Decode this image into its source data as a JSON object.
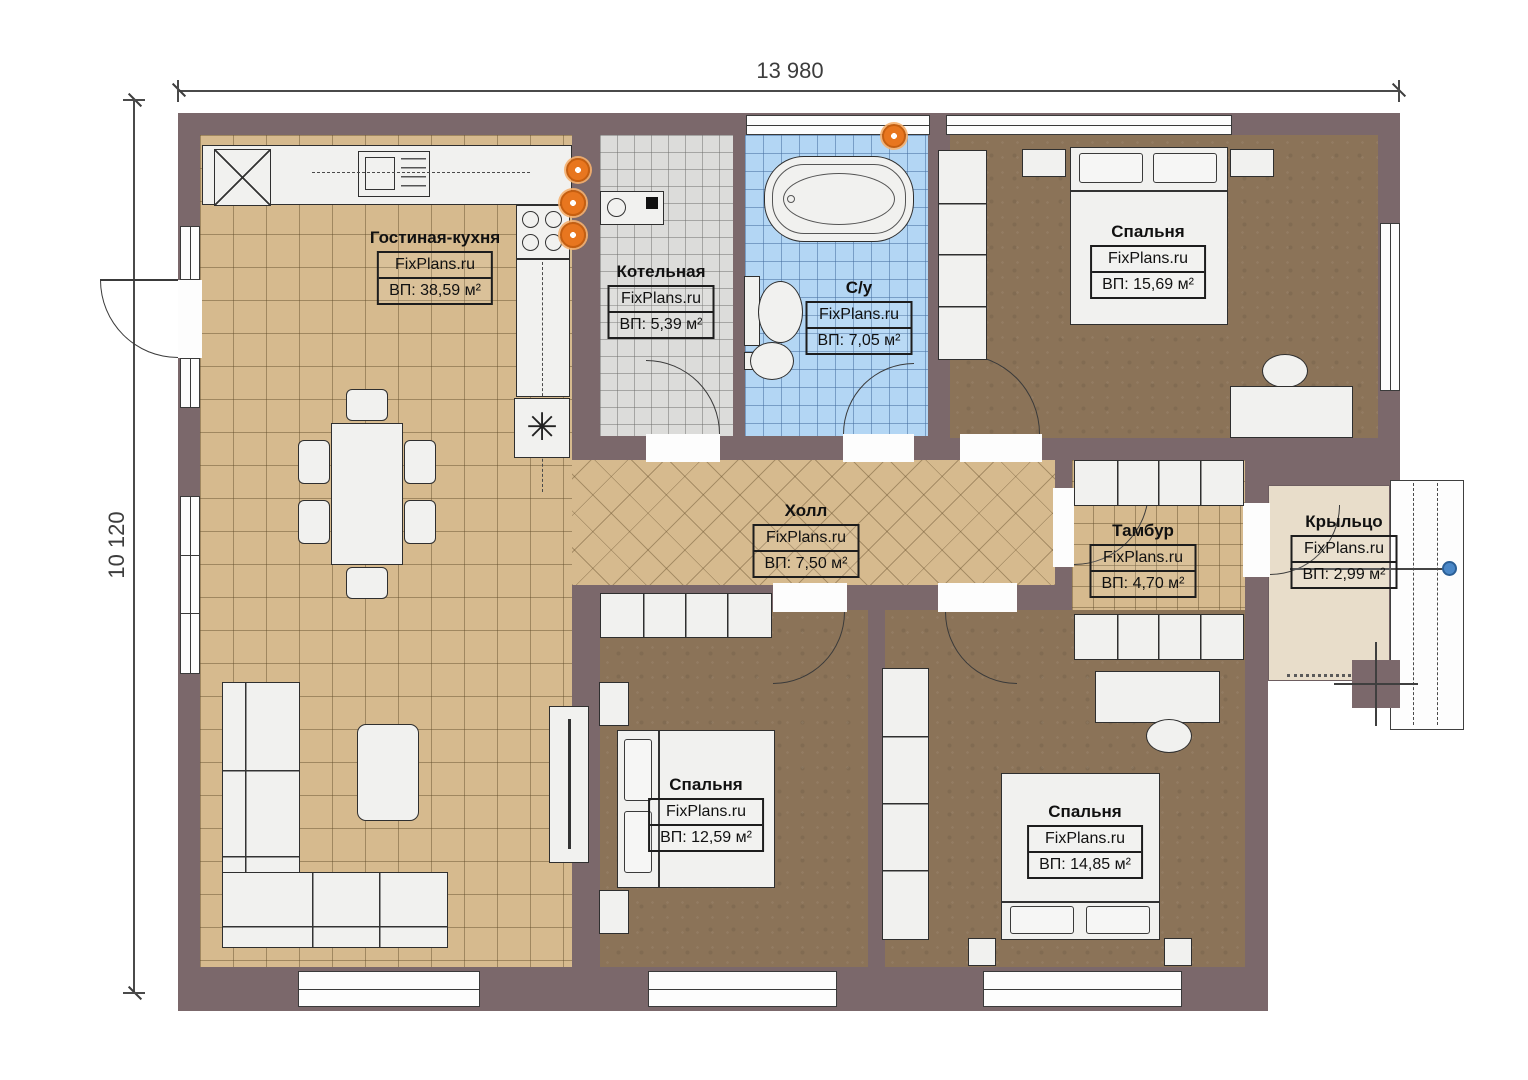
{
  "plan": {
    "width_dimension": "13 980",
    "height_dimension": "10 120"
  },
  "watermark": "FixPlans.ru",
  "rooms": {
    "living_kitchen": {
      "name": "Гостиная-кухня",
      "area": "ВП: 38,59 м²"
    },
    "boiler": {
      "name": "Котельная",
      "area": "ВП: 5,39 м²"
    },
    "bathroom": {
      "name": "С/у",
      "area": "ВП: 7,05 м²"
    },
    "bedroom_top": {
      "name": "Спальня",
      "area": "ВП: 15,69 м²"
    },
    "hall": {
      "name": "Холл",
      "area": "ВП: 7,50 м²"
    },
    "vestibule": {
      "name": "Тамбур",
      "area": "ВП: 4,70 м²"
    },
    "porch": {
      "name": "Крыльцо",
      "area": "ВП: 2,99 м²"
    },
    "bedroom_middle": {
      "name": "Спальня",
      "area": "ВП: 12,59 м²"
    },
    "bedroom_right": {
      "name": "Спальня",
      "area": "ВП: 14,85 м²"
    }
  },
  "symbols": {
    "water_heater": "✳"
  },
  "colors": {
    "wall": "#7b686b",
    "floor_wood": "#d6ba8e",
    "floor_bedroom": "#8b7358",
    "floor_boiler": "#dcdcda",
    "floor_bath": "#b3d6f4",
    "floor_porch": "#e8ddca",
    "accent_orange": "#e8761f",
    "marker_blue": "#4a87c7"
  }
}
